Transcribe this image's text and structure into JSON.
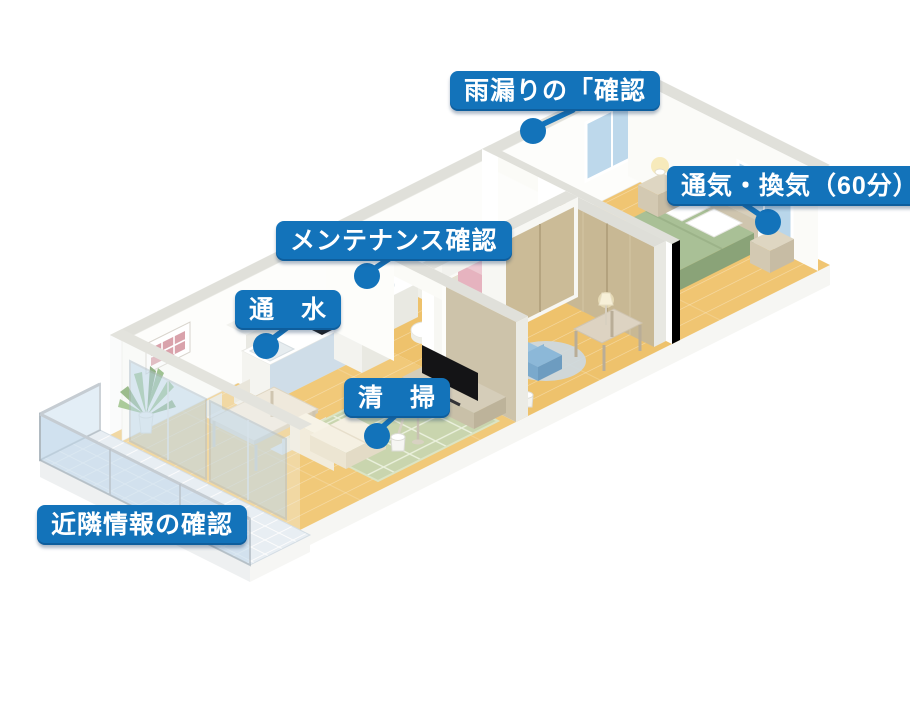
{
  "figure": {
    "type": "isometric-apartment-floorplan-callout-diagram",
    "language": "ja",
    "background": "#ffffff"
  },
  "callouts": [
    {
      "id": "rain-leak-check",
      "label": "雨漏りの「確認",
      "target": "roof-wall-top-above-bathroom"
    },
    {
      "id": "ventilation",
      "label": "通気・換気（60分）",
      "target": "bedroom-window"
    },
    {
      "id": "maintenance-check",
      "label": "メンテナンス確認",
      "target": "kitchen-hall-wall"
    },
    {
      "id": "water-flow",
      "label": "通　水",
      "target": "kitchen-sink-counter"
    },
    {
      "id": "cleaning",
      "label": "清　掃",
      "target": "living-room-floor"
    },
    {
      "id": "neighborhood-check",
      "label": "近隣情報の確認",
      "target": "balcony"
    }
  ],
  "colors": {
    "accent_blue": "#1373ba",
    "label_text": "#ffffff",
    "wood_floor": "#f0c470",
    "wall_white": "#ffffff",
    "wall_top": "#e0e0da",
    "closet_tan": "#c8b894",
    "bed_green": "#a9c096",
    "rug_green": "#c9d5ae",
    "balcony_tile": "#e8eef3",
    "glass_blue": "#bcd7ea",
    "pink_furniture": "#e6b3bf",
    "counter_blue": "#cfdde8",
    "tv_black": "#141416"
  },
  "scene": {
    "rooms": [
      "living-dining-room",
      "kitchen",
      "bathroom",
      "middle-room",
      "bedroom",
      "hallway",
      "balcony"
    ],
    "objects": [
      "balcony-glass-railing",
      "balcony-tiled-floor",
      "glass-sliding-doors",
      "potted-plant",
      "picture-frame",
      "dining-table",
      "dining-chairs",
      "kitchen-island-counter",
      "cooktop",
      "kitchen-sink",
      "refrigerator",
      "microwave",
      "sofa",
      "green-grid-rug",
      "floor-lamp",
      "cleaning-bucket",
      "tv",
      "tv-stand",
      "bathtub",
      "washbasin",
      "toilet",
      "pink-bunk",
      "yellow-cushion",
      "closet-sliding-doors",
      "round-rug",
      "blue-chair",
      "desk",
      "desk-lamp",
      "double-bed",
      "pillows",
      "nightstands",
      "bedside-lamps",
      "bedroom-window",
      "back-window"
    ]
  }
}
